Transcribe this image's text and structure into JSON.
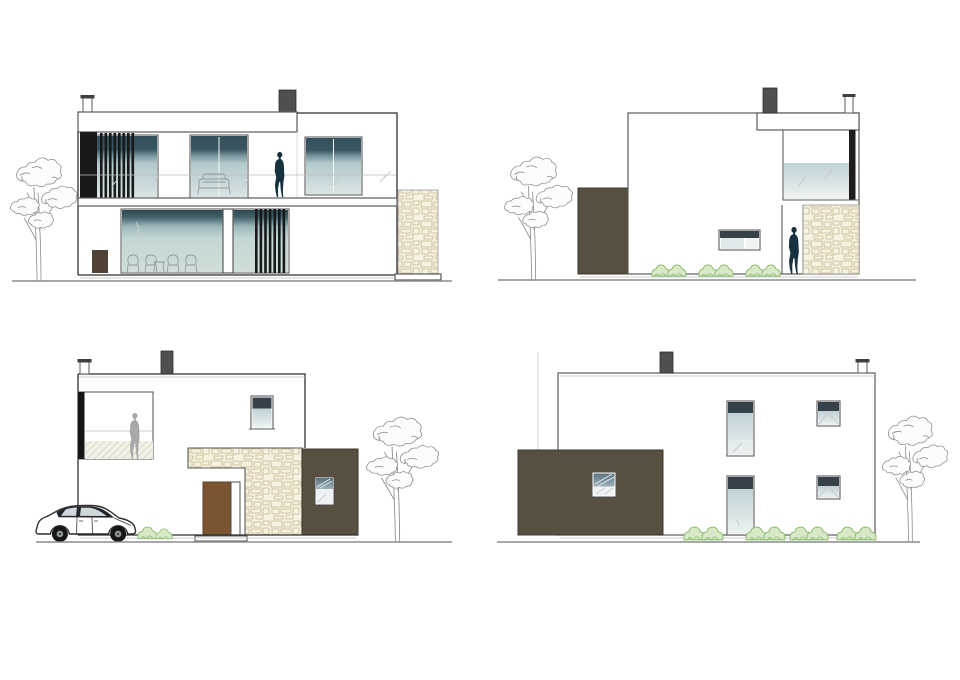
{
  "canvas": {
    "width": 960,
    "height": 680,
    "background": "#ffffff"
  },
  "colors": {
    "outline": "#5a5a5a",
    "outline_dark": "#2f2f2f",
    "chimney": "#4f4f4f",
    "louver": "#17191b",
    "blind": "#36424a",
    "person": "#16313f",
    "person_gray": "#a8a8a8",
    "olive": "#575041",
    "olive_edge": "#3e382c",
    "door": "#7b5531",
    "bush_fill": "#d9e8c7",
    "bush_line": "#8fbe72",
    "tree": "#8a8a8a",
    "ground": "#8c8c8c",
    "car": "#20262c",
    "bg": "#ffffff",
    "glass_dark": "#33515b",
    "glass_light": "#dbe6e6",
    "stone_bg": "#f6f2e2",
    "stone_line": "#cbbc92"
  },
  "elevations": [
    {
      "id": "elevation-top-left",
      "position": "top-left",
      "features": [
        "two-story-facade",
        "vertical-louvers",
        "glass-balustrade",
        "balcony-person",
        "sofa-silhouette",
        "dining-chairs",
        "stone-pier",
        "tree",
        "two-chimneys"
      ]
    },
    {
      "id": "elevation-top-right",
      "position": "top-right",
      "features": [
        "side-facade",
        "olive-annex-volume",
        "recessed-corner-window",
        "small-strip-window",
        "doorway-person",
        "stone-wall",
        "bushes",
        "tree",
        "two-chimneys"
      ]
    },
    {
      "id": "elevation-bottom-left",
      "position": "bottom-left",
      "features": [
        "entry-facade",
        "corner-window-with-person",
        "stone-entry-canopy",
        "front-door-with-sidelight",
        "olive-volume-with-window",
        "parked-car",
        "bushes",
        "tree",
        "two-chimneys"
      ]
    },
    {
      "id": "elevation-bottom-right",
      "position": "bottom-right",
      "features": [
        "rear-facade",
        "olive-garage-volume",
        "two-tall-windows",
        "two-small-windows",
        "garage-window",
        "bushes",
        "tree",
        "two-chimneys"
      ]
    }
  ]
}
